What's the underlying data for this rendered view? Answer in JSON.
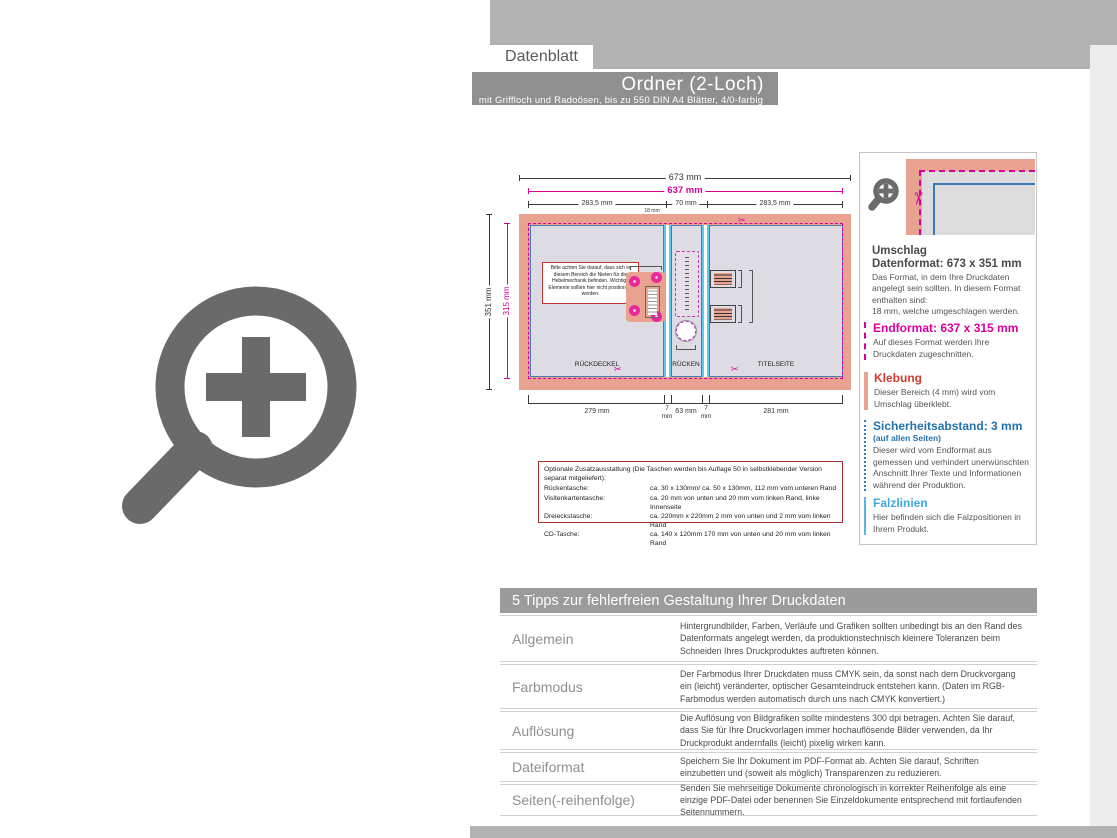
{
  "icons": {
    "scissors": "✂"
  },
  "colors": {
    "accent_magenta": "#d6009e",
    "accent_blue": "#2273ae",
    "accent_cyan": "#58b5e8",
    "accent_red": "#d43b2f",
    "salmon": "#e8a28f",
    "band_gray": "#b2b2b2",
    "bar_gray": "#8f8f8f"
  },
  "header": {
    "tab_label": "Datenblatt",
    "title": "Ordner (2-Loch)",
    "subtitle": "mit Griffloch und Radoösen, bis zu 550 DIN A4 Blätter, 4/0-farbig"
  },
  "diagram": {
    "dim_total_width": "673 mm",
    "dim_end_width": "637 mm",
    "dim_left_half": "283,5 mm",
    "dim_spine_top": "70 mm",
    "dim_right_half": "283,5 mm",
    "dim_total_height": "351 mm",
    "dim_end_height": "315 mm",
    "dim_flap": "18 mm",
    "dim_back": "279 mm",
    "dim_fold": "7",
    "dim_fold_unit": "mm",
    "dim_spine_bottom": "63 mm",
    "dim_front": "281 mm",
    "label_back": "RÜCKDECKEL",
    "label_spine": "RÜCKEN",
    "label_front": "TITELSEITE",
    "note_box": "Bitte achten Sie darauf, dass sich in diesem Bereich die Nieten für die Hebelmechanik befinden. Wichtige Elemente sollten hier nicht positioniert werden."
  },
  "info_panel": {
    "umschlag_title": "Umschlag",
    "datenformat_title": "Datenformat: 673 x 351 mm",
    "datenformat_body": "Das Format, in dem Ihre Druckdaten angelegt sein sollten. In diesem Format enthalten sind:\n18 mm, welche umgeschlagen werden.",
    "endformat_title": "Endformat: 637 x 315 mm",
    "endformat_body": "Auf dieses Format werden Ihre Druckdaten zugeschnitten.",
    "klebung_title": "Klebung",
    "klebung_body": "Dieser Bereich (4 mm) wird vom Umschlag überklebt.",
    "sicherheit_title": "Sicherheitsabstand: 3 mm",
    "sicherheit_sub": "(auf allen Seiten)",
    "sicherheit_body": "Dieser wird vom Endformat aus gemessen und verhindert unerwünschten Anschnitt Ihrer Texte und Informationen während der Produktion.",
    "falz_title": "Falzlinien",
    "falz_body": "Hier befinden sich die Falzpositionen in Ihrem Produkt."
  },
  "optional_box": {
    "intro": "Optionale Zusatzausstattung (Die Taschen werden bis Auflage 50 in selbstklebender Version separat mitgeliefert):",
    "rows": [
      {
        "label": "Rückentasche:",
        "value": "ca. 30 x 130mm/ ca. 50 x 130mm, 112 mm vom unteren Rand"
      },
      {
        "label": "Visitenkartentasche:",
        "value": "ca. 20 mm von unten und 20 mm vom linken Rand, linke Innenseite"
      },
      {
        "label": "Dreieckstasche:",
        "value": "ca. 220mm x 220mm 2 mm von unten und 2 mm vom linken Rand"
      },
      {
        "label": "CD-Tasche:",
        "value": "ca. 140 x 120mm 170 mm von unten und 20 mm vom linken Rand"
      }
    ]
  },
  "tips": {
    "header": "5 Tipps zur fehlerfreien Gestaltung Ihrer Druckdaten",
    "rows": [
      {
        "label": "Allgemein",
        "text": "Hintergrundbilder, Farben, Verläufe und Grafiken sollten unbedingt bis an den Rand des Datenformats angelegt werden, da produktionstechnisch kleinere Toleranzen beim Schneiden Ihres Druckproduktes auftreten können."
      },
      {
        "label": "Farbmodus",
        "text": "Der Farbmodus Ihrer Druckdaten muss CMYK sein, da sonst nach dem Druckvorgang ein (leicht) veränderter, optischer Gesamteindruck entstehen kann. (Daten im RGB-Farbmodus werden automatisch durch uns nach CMYK konvertiert.)"
      },
      {
        "label": "Auflösung",
        "text": "Die Auflösung von Bildgrafiken sollte mindestens 300 dpi betragen. Achten Sie darauf, dass Sie für Ihre Druckvorlagen immer hochauflösende Bilder verwenden, da Ihr Druckprodukt andernfalls (leicht) pixelig wirken kann."
      },
      {
        "label": "Dateiformat",
        "text": "Speichern Sie Ihr Dokument im PDF-Format ab. Achten Sie darauf, Schriften einzubetten und (soweit als möglich) Transparenzen zu reduzieren."
      },
      {
        "label": "Seiten(-reihenfolge)",
        "text": "Senden Sie mehrseitige Dokumente chronologisch in korrekter Reihenfolge als eine einzige PDF-Datei oder benennen Sie Einzeldokumente entsprechend mit fortlaufenden Seitennummern."
      }
    ]
  }
}
